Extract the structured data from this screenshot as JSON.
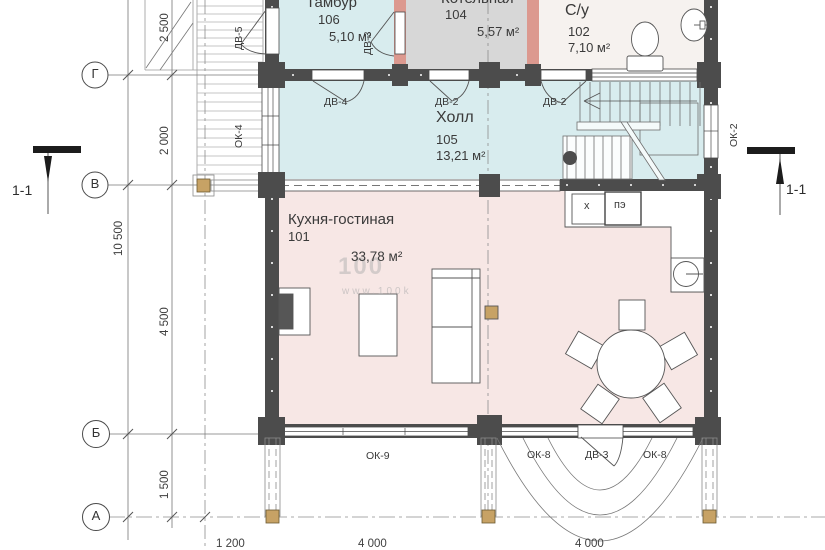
{
  "rooms": {
    "tambur": {
      "name": "Тамбур",
      "num": "106",
      "area": "5,10 м²"
    },
    "kotelnaya": {
      "name": "Котельная",
      "num": "104",
      "area": "5,57 м²"
    },
    "su": {
      "name": "С/у",
      "num": "102",
      "area": "7,10 м²"
    },
    "hall": {
      "name": "Холл",
      "num": "105",
      "area": "13,21 м²"
    },
    "kitchen": {
      "name": "Кухня-гостиная",
      "num": "101",
      "area": "33,78 м²"
    }
  },
  "axes": {
    "row_g": "Г",
    "row_v": "В",
    "row_b": "Б",
    "row_a": "А"
  },
  "dims": {
    "v2500": "2 500",
    "v2000": "2 000",
    "v4500": "4 500",
    "v1500": "1 500",
    "v10500": "10 500",
    "h1200": "1 200",
    "h4000a": "4 000",
    "h4000b": "4 000"
  },
  "openings": {
    "dv4": "ДВ-4",
    "dv2a": "ДВ-2",
    "dv2b": "ДВ-2",
    "dv3_tambur": "ДВ-3",
    "dv3_terrace": "ДВ-3",
    "dv5": "ДВ-5",
    "ok2": "ОК-2",
    "ok4": "ОК-4",
    "ok8a": "ОК-8",
    "ok8b": "ОК-8",
    "ok9": "ОК-9"
  },
  "kitchen_units": {
    "fridge": "х",
    "stove": "пэ"
  },
  "section": {
    "label": "1-1"
  },
  "watermark": {
    "line1": "100",
    "line2": "www.100k"
  },
  "colors": {
    "wall": "#4c4c4c",
    "wall_pink": "#dc998f",
    "room_cyan": "#d8ecee",
    "room_gray": "#d7d7d7",
    "room_pink": "#f7e7e5",
    "room_white": "#f6f2ef",
    "timber": "#c7a265"
  }
}
